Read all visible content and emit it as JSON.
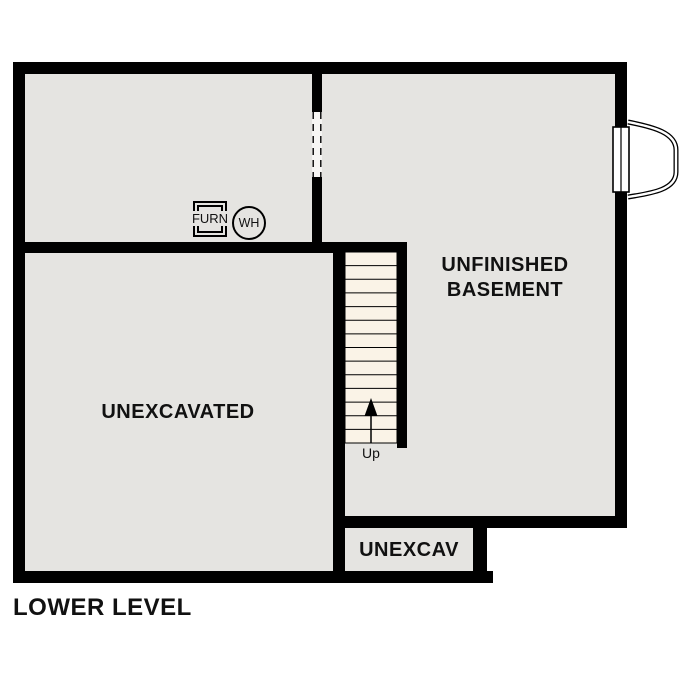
{
  "title": "LOWER LEVEL",
  "rooms": {
    "basement": {
      "line1": "UNFINISHED",
      "line2": "BASEMENT"
    },
    "unexcavated": {
      "label": "UNEXCAVATED"
    },
    "unexcav": {
      "label": "UNEXCAV"
    }
  },
  "fixtures": {
    "furnace": "FURN",
    "water_heater": "WH"
  },
  "stairs": {
    "label": "Up",
    "treads": 14
  },
  "colors": {
    "wall": "#000000",
    "floor": "#e5e4e1",
    "stair_fill": "#faf3e7",
    "gap": "#f7f6f4",
    "ink": "#111111"
  }
}
